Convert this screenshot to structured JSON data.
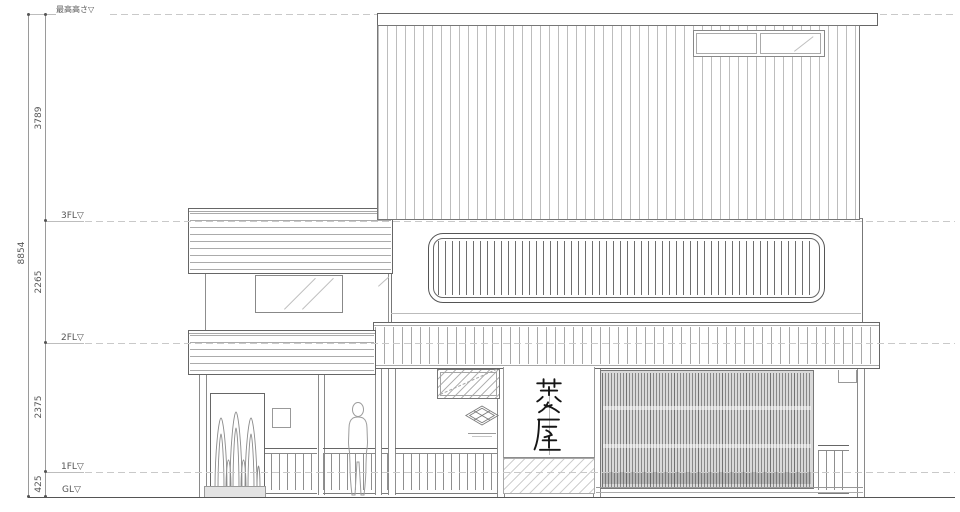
{
  "drawing": {
    "type": "architectural-elevation",
    "levels": {
      "max_height": "最高高さ▽",
      "fl3": "3FL▽",
      "fl2": "2FL▽",
      "fl1": "1FL▽",
      "gl": "GL▽"
    },
    "dimensions": {
      "total": "8854",
      "fl3_to_top": "3789",
      "fl2_to_fl3": "2265",
      "fl1_to_fl2": "2375",
      "gl_to_fl1": "425"
    },
    "noren": {
      "text": "菱屋"
    },
    "logo": {
      "name": "hishi-diamond-logo"
    },
    "colors": {
      "line": "#666666",
      "light_line": "#b5b5b5",
      "dashed_level": "#c9c9c9",
      "screen_fill": "#d9d9d9",
      "ink": "#1a1a1a",
      "paper": "#ffffff"
    }
  }
}
